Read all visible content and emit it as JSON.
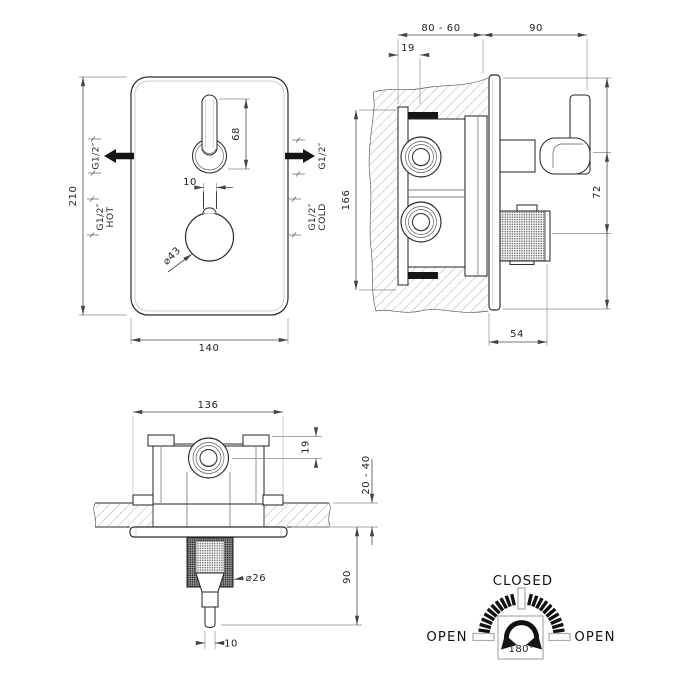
{
  "front_view": {
    "dim_height": "210",
    "dim_width": "140",
    "dim_handle_length": "68",
    "dim_stem_width": "10",
    "knob_diameter": "⌀43",
    "outlet_left": "G1/2″",
    "outlet_right": "G1/2″",
    "hot_size": "G1/2″",
    "hot_label": "HOT",
    "cold_size": "G1/2″",
    "cold_label": "COLD"
  },
  "side_view": {
    "dim_depth_range": "80 - 60",
    "dim_protrusion": "90",
    "dim_plate_offset": "19",
    "dim_body_height": "166",
    "dim_handle_spacing": "72",
    "dim_knob_depth": "54"
  },
  "bottom_view": {
    "dim_body_width": "136",
    "dim_port_offset": "19",
    "dim_wall_range": "20 - 40",
    "dim_protrusion": "90",
    "knob_diameter": "⌀26",
    "dim_handle_width": "10"
  },
  "dial": {
    "closed_label": "CLOSED",
    "open_left_label": "OPEN",
    "open_right_label": "OPEN",
    "rotation_label": "180°"
  },
  "colors": {
    "object_line": "#2b2b2b",
    "dimension_line": "#4a4a4a",
    "hatch": "#9a9a9a",
    "dial_gray": "#ababab"
  }
}
